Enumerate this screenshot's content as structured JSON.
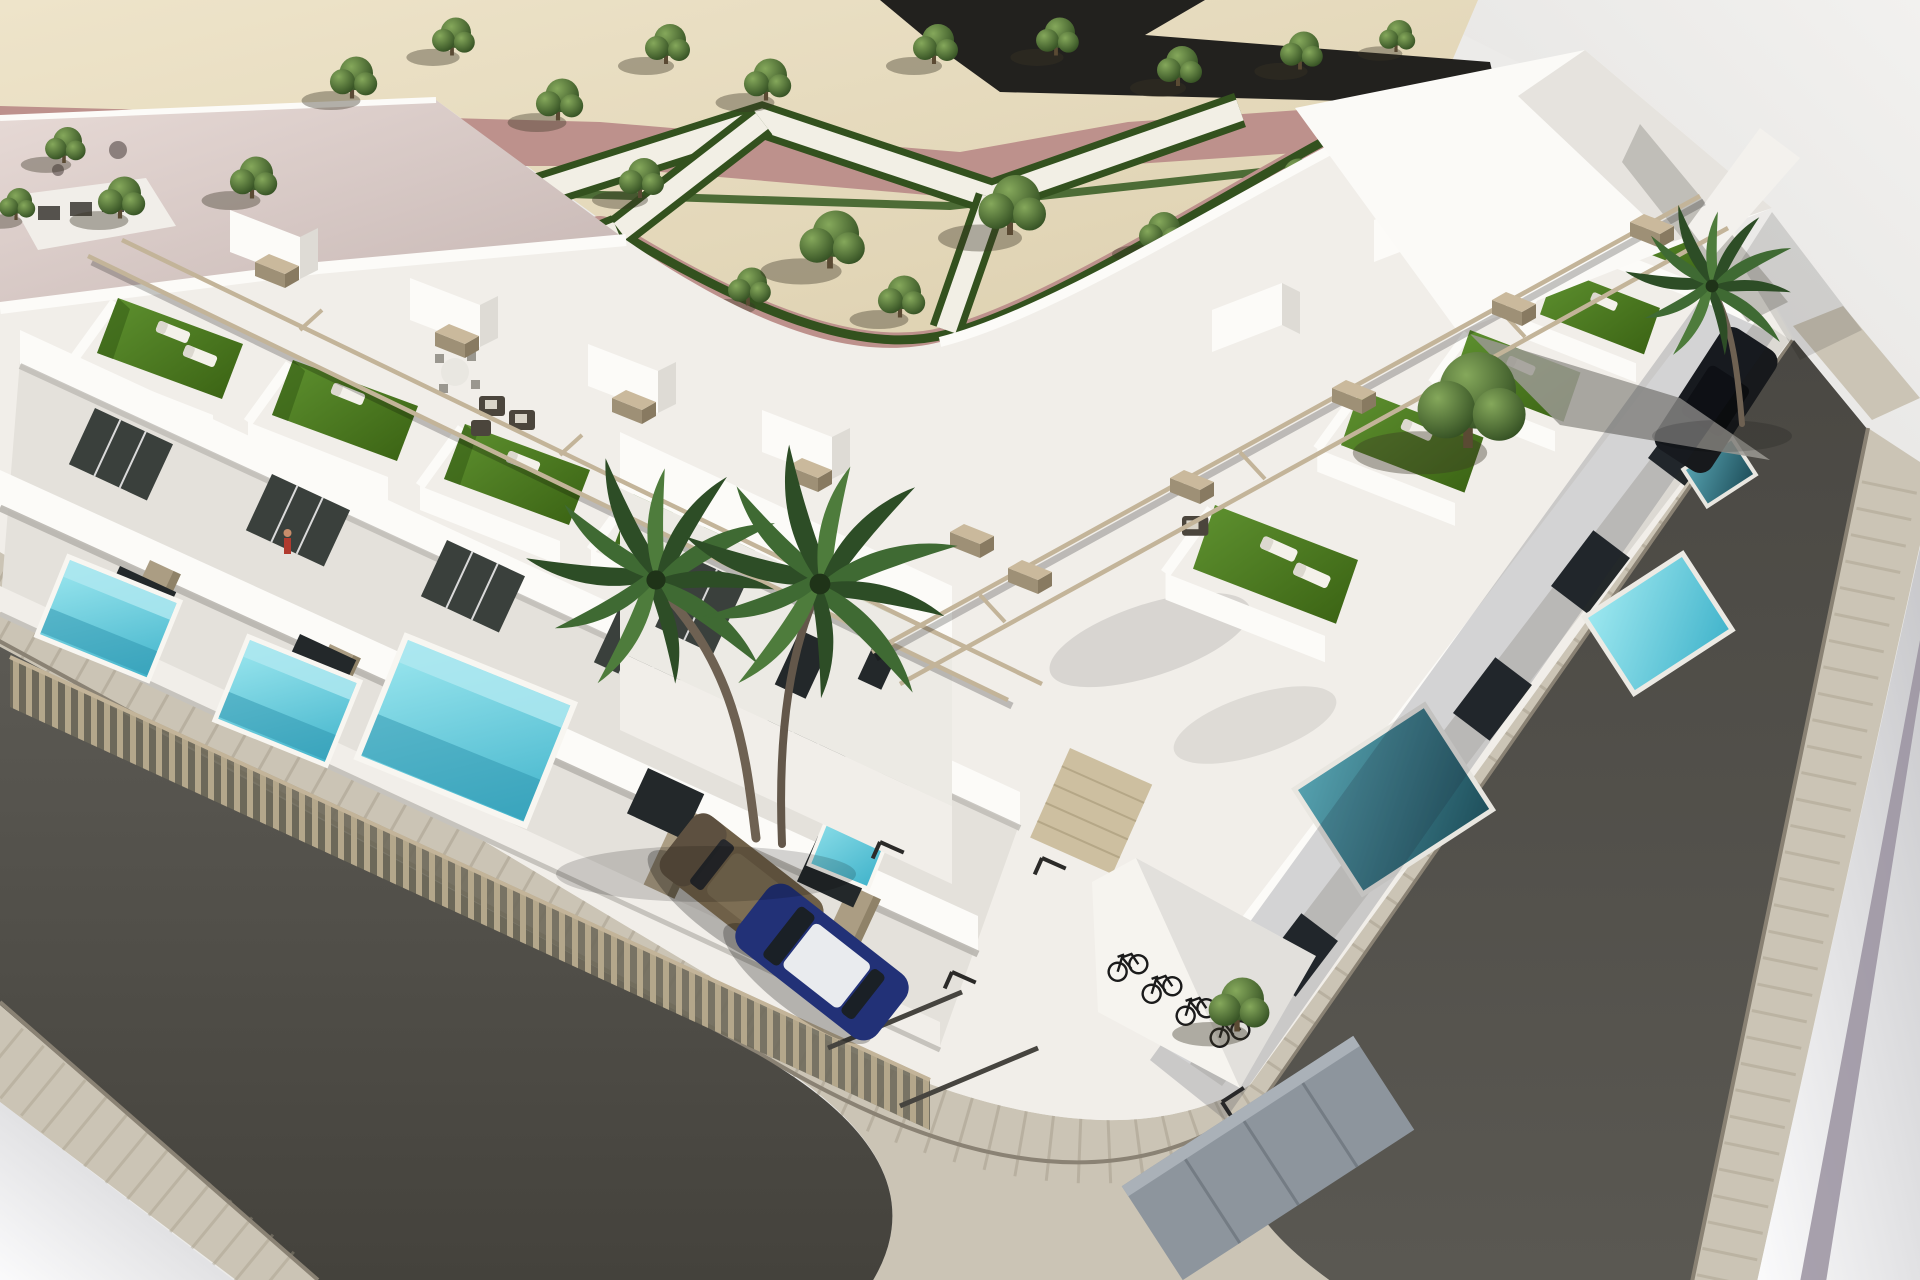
{
  "meta": {
    "description": "Aerial three-quarter 3D architectural rendering of a modern white residential development on a street corner: two rows of flat-roofed townhouses with rooftop solarium terraces (artificial turf, sun loungers, pergola rails), private turquoise plunge pools behind slatted fences, an interior driveway with parked bronze and blue cars, a bicycle parking corner, paved sidewalks wrapping dark asphalt streets, and a landscaped park with geometric hedges, gravel ground, pink paths and rows of trees at the top left.",
    "image_type": "3d-render",
    "width_px": 1920,
    "height_px": 1280
  },
  "scene": {
    "view": "high-angle aerial view of a corner plot, sunlight from upper right, soft shadows cast to lower left",
    "areas": [
      "landscaped park with zig-zag geometric hedges and white walking paths on sand gravel",
      "dusty-pink pedestrian paths bordering the park",
      "dark service road strip at top edge",
      "existing building with large pale-pink flat roof at top left",
      "left row of white townhouses with rooftop terraces and street-side pools",
      "right row of white townhouses with shaded pools along the side street",
      "faceted white roof structure at top right of the complex",
      "interior driveway with marked parking bays, garage door and bicycle corner",
      "asphalt streets with paved tile sidewalks meeting at a rounded corner",
      "vacant light-grey lot at top right",
      "white open ground at bottom-left and far-right corners with a mauve stripe"
    ],
    "counts": {
      "rooftop_terraces_with_turf": 10,
      "private_pools": 7,
      "park_trees": 22,
      "palm_trees": 2,
      "parked_cars": 3,
      "bicycles": 4,
      "garage_doors": 1,
      "bike_sheds": 1,
      "people": 1
    },
    "vehicles": [
      "bronze hatchback",
      "blue hatchback with white roof",
      "black car in side yard"
    ]
  },
  "colors": {
    "sand": "#e8dec4",
    "parkPath": "#f2efe5",
    "hedge": "#4d6c36",
    "hedgeDark": "#33511e",
    "pinkPath": "#bd918c",
    "topRoad": "#22211e",
    "treeLight": "#7fa153",
    "treeDark": "#2a451c",
    "trunk": "#5a4a33",
    "roofPink": "#e0d3d0",
    "wallWhite": "#fcfbf8",
    "wallWarm": "#f1eee9",
    "wallShade": "#dcd9d3",
    "glass": "#3a403c",
    "glassDeep": "#23282a",
    "turf": "#4f7d27",
    "pergola": "#c3b499",
    "stone": "#ab9d83",
    "fence": "#b4a78b",
    "fenceGap": "#6f6a5b",
    "poolBright": "#60cbdc",
    "poolPale": "#aee8f0",
    "poolShade": "#3a8093",
    "poolDeep": "#235763",
    "sidewalk": "#cbc4b5",
    "sidewalkJoint": "#a29a88",
    "curb": "#8a8274",
    "roadLeft": "#56544e",
    "roadRight": "#504e48",
    "lot": "#ebeae8",
    "groundLight": "#f6f6f7",
    "groundShade": "#cccccf",
    "loungerPad": "#f4f1ea",
    "wicker": "#4b453c",
    "carBronze": "#6f6048",
    "carBlue": "#223177",
    "carRoof": "#e9ebee",
    "carBlack": "#17191c",
    "bike": "#1b1b1b",
    "shed": "#8d959d",
    "garage": "#cdbfa0",
    "mauve": "#9a92a0",
    "person": "#b03a2e"
  }
}
